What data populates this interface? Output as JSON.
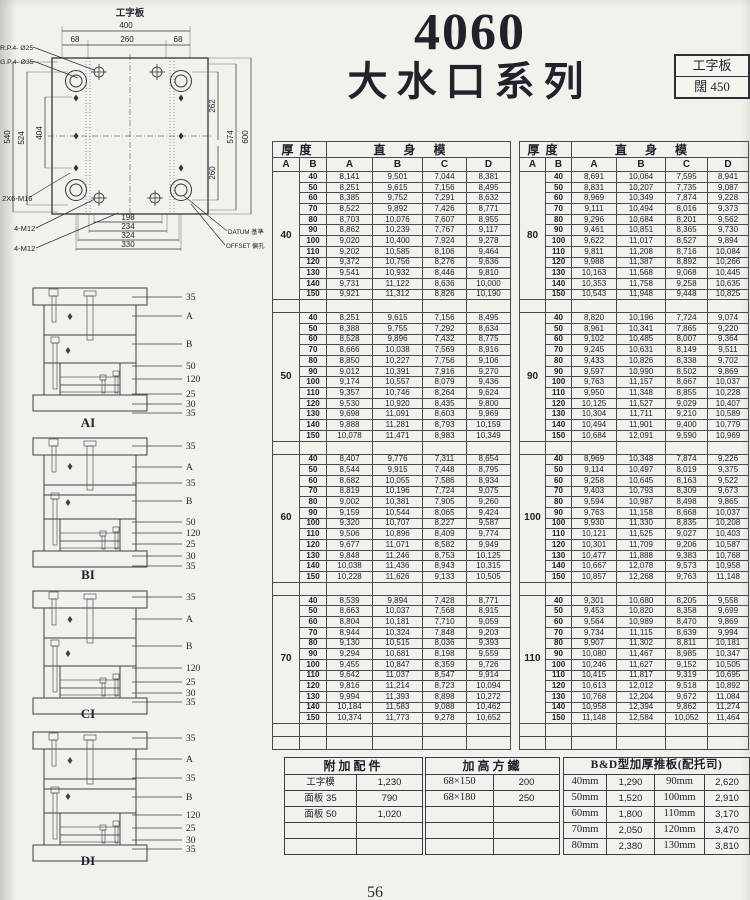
{
  "header": {
    "model": "4060",
    "series": "大水口系列",
    "corner_box": {
      "line1": "工字板",
      "line2": "闊 450"
    }
  },
  "page_number": "56",
  "drawing": {
    "plate_label": "工字板",
    "top": [
      "400",
      "68",
      "260",
      "68"
    ],
    "left": [
      "540",
      "524",
      "404"
    ],
    "right": [
      "262",
      "260",
      "574",
      "600"
    ],
    "bottom": [
      "198",
      "234",
      "324",
      "330"
    ],
    "callouts_left": [
      "R.P.4- Ø25",
      "G.P.4- Ø35",
      "2X6-M16",
      "4-M12",
      "4-M12"
    ],
    "callouts_right": [
      "DATUM 基準",
      "OFFSET 偏孔"
    ]
  },
  "sections": [
    {
      "label": "AI",
      "callouts": [
        "35",
        "A",
        "B",
        "50",
        "120",
        "25",
        "30",
        "35"
      ]
    },
    {
      "label": "BI",
      "callouts": [
        "35",
        "A",
        "35",
        "B",
        "50",
        "120",
        "25",
        "30",
        "35"
      ]
    },
    {
      "label": "CI",
      "callouts": [
        "35",
        "A",
        "B",
        "120",
        "25",
        "30",
        "35"
      ]
    },
    {
      "label": "DI",
      "callouts": [
        "35",
        "A",
        "35",
        "B",
        "120",
        "25",
        "30",
        "35"
      ]
    }
  ],
  "main_tables": {
    "thickness_header": "厚度",
    "mold_header": "直身模",
    "sub_headers": [
      "A",
      "B",
      "A",
      "B",
      "C",
      "D"
    ],
    "left_groups": [
      {
        "a": "40",
        "rows": [
          [
            "40",
            "8,141",
            "9,501",
            "7,044",
            "8,381"
          ],
          [
            "50",
            "8,251",
            "9,615",
            "7,156",
            "8,495"
          ],
          [
            "60",
            "8,385",
            "9,752",
            "7,291",
            "8,632"
          ],
          [
            "70",
            "8,522",
            "9,892",
            "7,426",
            "8,771"
          ],
          [
            "80",
            "8,703",
            "10,076",
            "7,607",
            "8,955"
          ],
          [
            "90",
            "8,862",
            "10,239",
            "7,767",
            "9,117"
          ],
          [
            "100",
            "9,020",
            "10,400",
            "7,924",
            "9,278"
          ],
          [
            "110",
            "9,202",
            "10,585",
            "8,106",
            "9,464"
          ],
          [
            "120",
            "9,372",
            "10,756",
            "8,276",
            "9,636"
          ],
          [
            "130",
            "9,541",
            "10,932",
            "8,446",
            "9,810"
          ],
          [
            "140",
            "9,731",
            "11,122",
            "8,636",
            "10,000"
          ],
          [
            "150",
            "9,921",
            "11,312",
            "8,826",
            "10,190"
          ]
        ]
      },
      {
        "a": "50",
        "rows": [
          [
            "40",
            "8,251",
            "9,615",
            "7,156",
            "8,495"
          ],
          [
            "50",
            "8,388",
            "9,755",
            "7,292",
            "8,634"
          ],
          [
            "60",
            "8,528",
            "9,896",
            "7,432",
            "8,775"
          ],
          [
            "70",
            "8,666",
            "10,038",
            "7,569",
            "8,916"
          ],
          [
            "80",
            "8,850",
            "10,227",
            "7,756",
            "9,106"
          ],
          [
            "90",
            "9,012",
            "10,391",
            "7,916",
            "9,270"
          ],
          [
            "100",
            "9,174",
            "10,557",
            "8,079",
            "9,436"
          ],
          [
            "110",
            "9,357",
            "10,746",
            "8,264",
            "9,624"
          ],
          [
            "120",
            "9,530",
            "10,920",
            "8,435",
            "9,800"
          ],
          [
            "130",
            "9,698",
            "11,091",
            "8,603",
            "9,969"
          ],
          [
            "140",
            "9,888",
            "11,281",
            "8,793",
            "10,159"
          ],
          [
            "150",
            "10,078",
            "11,471",
            "8,983",
            "10,349"
          ]
        ]
      },
      {
        "a": "60",
        "rows": [
          [
            "40",
            "8,407",
            "9,776",
            "7,311",
            "8,654"
          ],
          [
            "50",
            "8,544",
            "9,915",
            "7,448",
            "8,795"
          ],
          [
            "60",
            "8,682",
            "10,055",
            "7,586",
            "8,934"
          ],
          [
            "70",
            "8,819",
            "10,196",
            "7,724",
            "9,075"
          ],
          [
            "80",
            "9,002",
            "10,381",
            "7,905",
            "9,260"
          ],
          [
            "90",
            "9,159",
            "10,544",
            "8,065",
            "9,424"
          ],
          [
            "100",
            "9,320",
            "10,707",
            "8,227",
            "9,587"
          ],
          [
            "110",
            "9,506",
            "10,896",
            "8,409",
            "9,774"
          ],
          [
            "120",
            "9,677",
            "11,071",
            "8,582",
            "9,949"
          ],
          [
            "130",
            "9,848",
            "11,246",
            "8,753",
            "10,125"
          ],
          [
            "140",
            "10,038",
            "11,436",
            "8,943",
            "10,315"
          ],
          [
            "150",
            "10,228",
            "11,626",
            "9,133",
            "10,505"
          ]
        ]
      },
      {
        "a": "70",
        "rows": [
          [
            "40",
            "8,539",
            "9,894",
            "7,428",
            "8,771"
          ],
          [
            "50",
            "8,663",
            "10,037",
            "7,568",
            "8,915"
          ],
          [
            "60",
            "8,804",
            "10,181",
            "7,710",
            "9,059"
          ],
          [
            "70",
            "8,944",
            "10,324",
            "7,848",
            "9,203"
          ],
          [
            "80",
            "9,130",
            "10,515",
            "8,036",
            "9,393"
          ],
          [
            "90",
            "9,294",
            "10,681",
            "8,198",
            "9,559"
          ],
          [
            "100",
            "9,455",
            "10,847",
            "8,359",
            "9,726"
          ],
          [
            "110",
            "9,642",
            "11,037",
            "8,547",
            "9,914"
          ],
          [
            "120",
            "9,816",
            "11,214",
            "8,723",
            "10,094"
          ],
          [
            "130",
            "9,994",
            "11,393",
            "8,898",
            "10,272"
          ],
          [
            "140",
            "10,184",
            "11,583",
            "9,088",
            "10,462"
          ],
          [
            "150",
            "10,374",
            "11,773",
            "9,278",
            "10,652"
          ]
        ]
      }
    ],
    "right_groups": [
      {
        "a": "80",
        "rows": [
          [
            "40",
            "8,691",
            "10,064",
            "7,595",
            "8,941"
          ],
          [
            "50",
            "8,831",
            "10,207",
            "7,735",
            "9,087"
          ],
          [
            "60",
            "8,969",
            "10,349",
            "7,874",
            "9,228"
          ],
          [
            "70",
            "9,111",
            "10,494",
            "8,016",
            "9,373"
          ],
          [
            "80",
            "9,296",
            "10,684",
            "8,201",
            "9,562"
          ],
          [
            "90",
            "9,461",
            "10,851",
            "8,365",
            "9,730"
          ],
          [
            "100",
            "9,622",
            "11,017",
            "8,527",
            "9,894"
          ],
          [
            "110",
            "9,811",
            "11,208",
            "8,716",
            "10,084"
          ],
          [
            "120",
            "9,988",
            "11,387",
            "8,892",
            "10,266"
          ],
          [
            "130",
            "10,163",
            "11,568",
            "9,068",
            "10,445"
          ],
          [
            "140",
            "10,353",
            "11,758",
            "9,258",
            "10,635"
          ],
          [
            "150",
            "10,543",
            "11,948",
            "9,448",
            "10,825"
          ]
        ]
      },
      {
        "a": "90",
        "rows": [
          [
            "40",
            "8,820",
            "10,196",
            "7,724",
            "9,074"
          ],
          [
            "50",
            "8,961",
            "10,341",
            "7,865",
            "9,220"
          ],
          [
            "60",
            "9,102",
            "10,485",
            "8,007",
            "9,364"
          ],
          [
            "70",
            "9,245",
            "10,631",
            "8,149",
            "9,511"
          ],
          [
            "80",
            "9,433",
            "10,826",
            "8,338",
            "9,702"
          ],
          [
            "90",
            "9,597",
            "10,990",
            "8,502",
            "9,869"
          ],
          [
            "100",
            "9,763",
            "11,157",
            "8,667",
            "10,037"
          ],
          [
            "110",
            "9,950",
            "11,348",
            "8,855",
            "10,228"
          ],
          [
            "120",
            "10,125",
            "11,527",
            "9,029",
            "10,407"
          ],
          [
            "130",
            "10,304",
            "11,711",
            "9,210",
            "10,589"
          ],
          [
            "140",
            "10,494",
            "11,901",
            "9,400",
            "10,779"
          ],
          [
            "150",
            "10,684",
            "12,091",
            "9,590",
            "10,969"
          ]
        ]
      },
      {
        "a": "100",
        "rows": [
          [
            "40",
            "8,969",
            "10,348",
            "7,874",
            "9,226"
          ],
          [
            "50",
            "9,114",
            "10,497",
            "8,019",
            "9,375"
          ],
          [
            "60",
            "9,258",
            "10,645",
            "8,163",
            "9,522"
          ],
          [
            "70",
            "9,403",
            "10,793",
            "8,309",
            "9,673"
          ],
          [
            "80",
            "9,594",
            "10,987",
            "8,498",
            "9,865"
          ],
          [
            "90",
            "9,763",
            "11,158",
            "8,668",
            "10,037"
          ],
          [
            "100",
            "9,930",
            "11,330",
            "8,835",
            "10,208"
          ],
          [
            "110",
            "10,121",
            "11,525",
            "9,027",
            "10,403"
          ],
          [
            "120",
            "10,301",
            "11,709",
            "9,206",
            "10,587"
          ],
          [
            "130",
            "10,477",
            "11,888",
            "9,383",
            "10,768"
          ],
          [
            "140",
            "10,667",
            "12,078",
            "9,573",
            "10,958"
          ],
          [
            "150",
            "10,857",
            "12,268",
            "9,763",
            "11,148"
          ]
        ]
      },
      {
        "a": "110",
        "rows": [
          [
            "40",
            "9,301",
            "10,680",
            "8,205",
            "9,558"
          ],
          [
            "50",
            "9,453",
            "10,820",
            "8,358",
            "9,699"
          ],
          [
            "60",
            "9,564",
            "10,989",
            "8,470",
            "9,869"
          ],
          [
            "70",
            "9,734",
            "11,115",
            "8,639",
            "9,994"
          ],
          [
            "80",
            "9,907",
            "11,302",
            "8,811",
            "10,181"
          ],
          [
            "90",
            "10,080",
            "11,467",
            "8,985",
            "10,347"
          ],
          [
            "100",
            "10,246",
            "11,627",
            "9,152",
            "10,505"
          ],
          [
            "110",
            "10,415",
            "11,817",
            "9,319",
            "10,695"
          ],
          [
            "120",
            "10,613",
            "12,012",
            "9,518",
            "10,892"
          ],
          [
            "130",
            "10,768",
            "12,204",
            "9,672",
            "11,084"
          ],
          [
            "140",
            "10,958",
            "12,394",
            "9,862",
            "11,274"
          ],
          [
            "150",
            "11,148",
            "12,584",
            "10,052",
            "11,464"
          ]
        ]
      }
    ]
  },
  "bottom_tables": {
    "accessories": {
      "title": "附加配件",
      "rows": [
        [
          "工字模",
          "1,230"
        ],
        [
          "面板 35",
          "790"
        ],
        [
          "面板 50",
          "1,020"
        ]
      ]
    },
    "risers": {
      "title": "加高方鐵",
      "rows": [
        [
          "68×150",
          "200"
        ],
        [
          "68×180",
          "250"
        ]
      ]
    },
    "bd_plate": {
      "title": "B&D型加厚推板(配托司)",
      "rows": [
        [
          "40mm",
          "1,290",
          "90mm",
          "2,620"
        ],
        [
          "50mm",
          "1,520",
          "100mm",
          "2,910"
        ],
        [
          "60mm",
          "1,800",
          "110mm",
          "3,170"
        ],
        [
          "70mm",
          "2,050",
          "120mm",
          "3,470"
        ],
        [
          "80mm",
          "2,380",
          "130mm",
          "3,810"
        ]
      ]
    }
  }
}
